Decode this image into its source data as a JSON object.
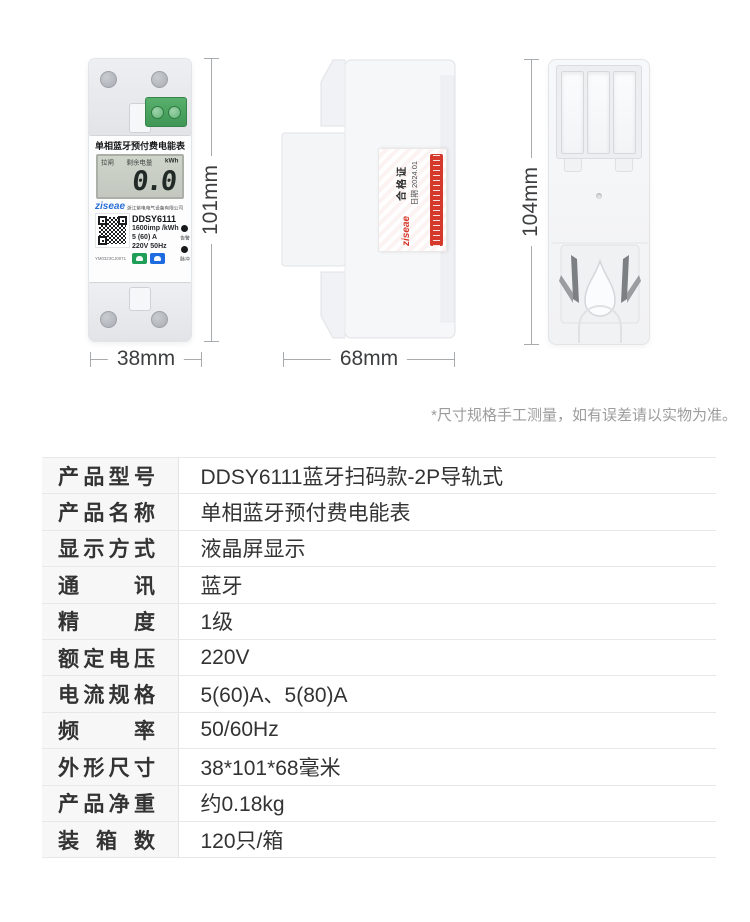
{
  "page": {
    "background": "#ffffff"
  },
  "showcase": {
    "front_view": {
      "panel_title": "单相蓝牙预付费电能表",
      "lcd": {
        "status_left": "拉闸",
        "status_mid": "剩余电量",
        "unit": "kWh",
        "reading": "0.0"
      },
      "brand": "ziseae",
      "company": "浙江紫电电气设备有限公司",
      "model": "DDSY6111",
      "impulse_rate": "1600imp /kWh",
      "current_spec": "5 (60) A",
      "voltage_spec": "220V 50Hz",
      "serial": "YM0323CJ0071",
      "indicators": {
        "alarm": "告警",
        "pulse": "脉冲"
      }
    },
    "side_view": {
      "brand": "ziseae",
      "cert_title": "合格证",
      "cert_date": "日期 2024.01"
    },
    "dimensions": {
      "front_width": "38mm",
      "front_height": "101mm",
      "side_depth": "68mm",
      "back_height": "104mm"
    }
  },
  "disclaimer": "*尺寸规格手工测量，如有误差请以实物为准。",
  "spec_table": {
    "rows": [
      {
        "label": "产品型号",
        "value": "DDSY6111蓝牙扫码款-2P导轨式"
      },
      {
        "label": "产品名称",
        "value": "单相蓝牙预付费电能表"
      },
      {
        "label": "显示方式",
        "value": "液晶屏显示"
      },
      {
        "label": "通　讯",
        "value": "蓝牙"
      },
      {
        "label": "精　度",
        "value": "1级"
      },
      {
        "label": "额定电压",
        "value": "220V"
      },
      {
        "label": "电流规格",
        "value": "5(60)A、5(80)A"
      },
      {
        "label": "频　率",
        "value": "50/60Hz"
      },
      {
        "label": "外形尺寸",
        "value": "38*101*68毫米"
      },
      {
        "label": "产品净重",
        "value": "约0.18kg"
      },
      {
        "label": "装 箱 数",
        "value": "120只/箱"
      }
    ]
  },
  "icons": {
    "qr_code": "checkerboard-pattern",
    "cloud_button": "white-blob-on-green",
    "bluetooth_button": "white-blob-on-blue",
    "alarm_indicator": "black-dot",
    "pulse_indicator": "black-dot"
  },
  "colors": {
    "accent_red": "#d5392b",
    "brand_blue": "#2a6fd6",
    "terminal_green": "#3f9655",
    "button_green": "#1f9e57",
    "button_blue": "#1e6ae0",
    "lcd_bg": "#c9cfc4",
    "label_col_bg": "#f7f7f8",
    "table_border": "#e7e8e9",
    "dim_line": "#a8abae",
    "text_dark": "#333333",
    "text_muted": "#9c9c9c"
  }
}
